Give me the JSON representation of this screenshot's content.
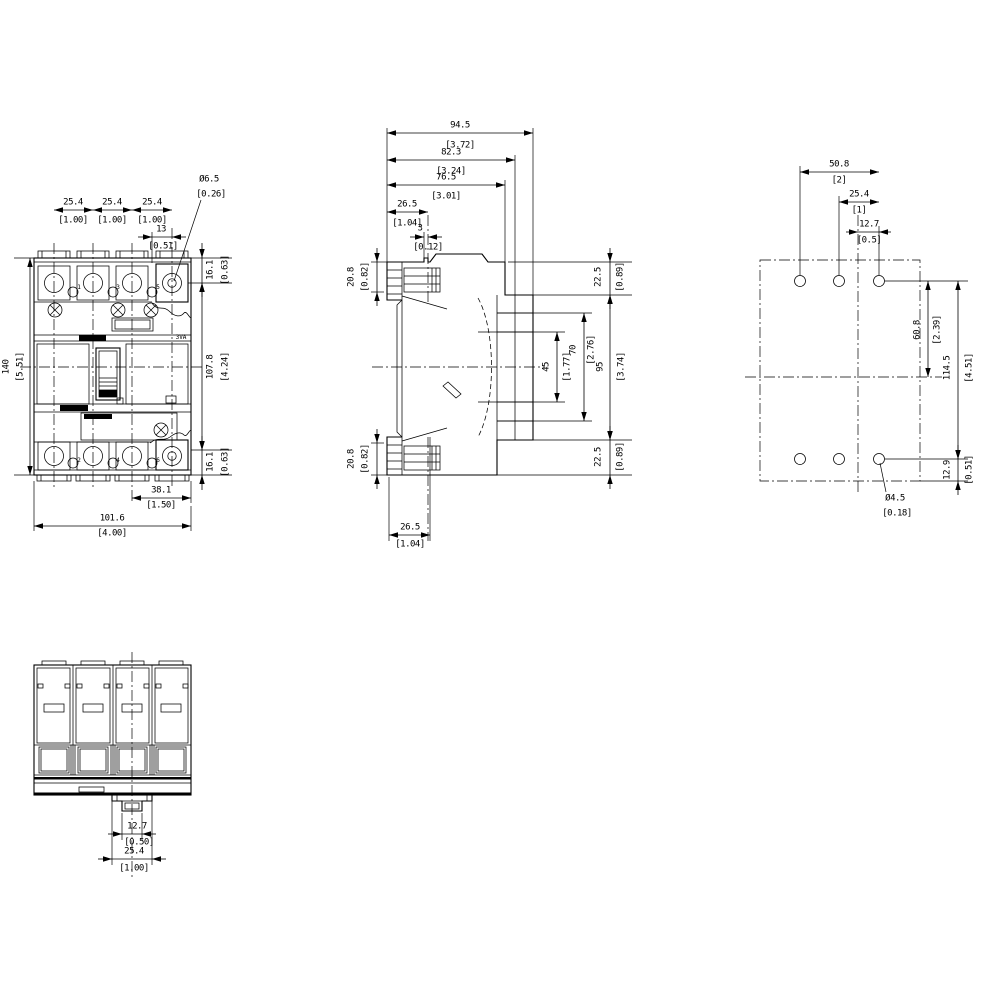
{
  "drawing": {
    "front": {
      "pitch_mm": "25.4",
      "pitch_in": "[1.00]",
      "hole_offset_mm": "13",
      "hole_offset_in": "[0.51]",
      "hole_dia_mm": "Ø6.5",
      "hole_dia_in": "[0.26]",
      "height_mm": "140",
      "height_in": "[5.51]",
      "top_mm": "16.1",
      "top_in": "[0.63]",
      "body_mm": "107.8",
      "body_in": "[4.24]",
      "bottom_mm": "16.1",
      "bottom_in": "[0.63]",
      "anchor_mm": "38.1",
      "anchor_in": "[1.50]",
      "width_mm": "101.6",
      "width_in": "[4.00]",
      "brand": "3VA",
      "pole_top": [
        "1",
        "3",
        "5"
      ],
      "pole_bottom": [
        "2",
        "4",
        "6"
      ]
    },
    "side": {
      "depth_mm": "94.5",
      "depth_in": "[3.72]",
      "rear_off_mm": "82.3",
      "rear_off_in": "[3.24]",
      "mount_off_mm": "76.5",
      "mount_off_in": "[3.01]",
      "front_off_mm": "26.5",
      "front_off_in": "[1.04]",
      "rib_mm": "3",
      "rib_in": "[0.12]",
      "lug_top_mm": "20.8",
      "lug_top_in": "[0.82]",
      "lug_bot_mm": "20.8",
      "lug_bot_in": "[0.82]",
      "top_right_mm": "22.5",
      "top_right_in": "[0.89]",
      "rail_inner_mm": "45",
      "rail_inner_in": "[1.77]",
      "rail_outer_mm": "70",
      "rail_outer_in": "[2.76]",
      "rear_height_mm": "95",
      "rear_height_in": "[3.74]",
      "bot_right_mm": "22.5",
      "bot_right_in": "[0.89]",
      "foot_mm": "26.5",
      "foot_in": "[1.04]"
    },
    "drill": {
      "span_mm": "50.8",
      "span_in": "[2]",
      "pitch_mm": "25.4",
      "pitch_in": "[1]",
      "half_mm": "12.7",
      "half_in": "[0.5]",
      "upper_mm": "60.8",
      "upper_in": "[2.39]",
      "total_mm": "114.5",
      "total_in": "[4.51]",
      "lower_mm": "12.9",
      "lower_in": "[0.51]",
      "hole_dia_mm": "Ø4.5",
      "hole_dia_in": "[0.18]"
    },
    "bottom": {
      "rail_mm": "12.7",
      "rail_in": "[0.50]",
      "clip_mm": "25.4",
      "clip_in": "[1.00]"
    }
  }
}
